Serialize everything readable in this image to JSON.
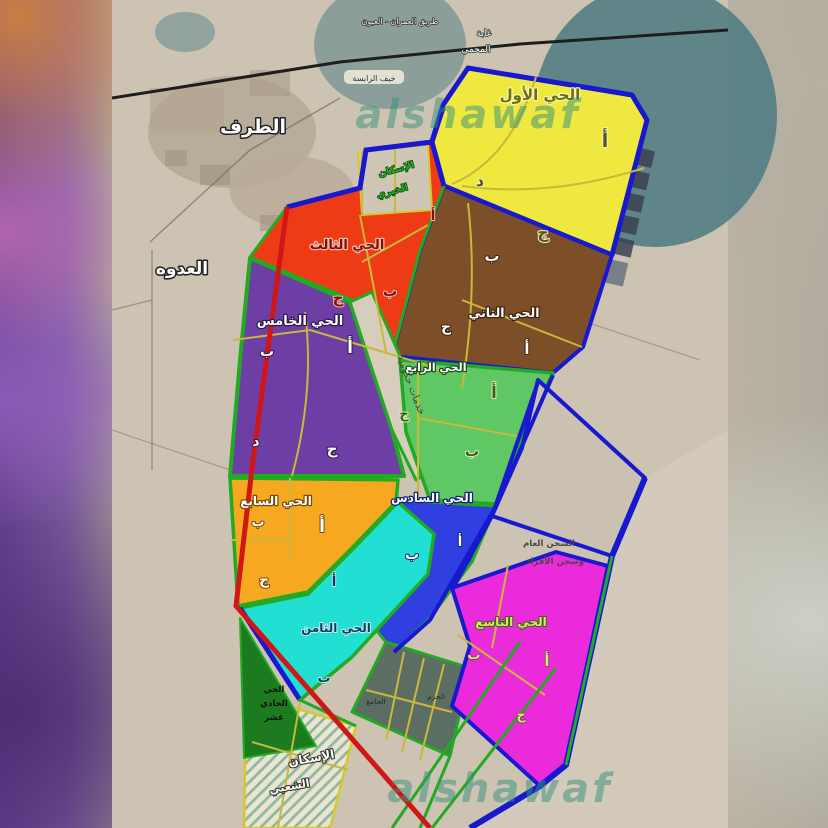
{
  "watermark": {
    "text": "alshawaf",
    "color": "#36907c"
  },
  "base_map": {
    "town_left": "الطرف",
    "town_left2": "العدوه",
    "road_top": "طريق العمران - العيون",
    "village_pill": "خيف الرابسة",
    "forest_l1": "غابة",
    "forest_l2": "المحمي"
  },
  "districts": [
    {
      "name": "الحي الأول",
      "color": "#efe93f",
      "sections": [
        "أ",
        "د",
        "ج"
      ]
    },
    {
      "name": "الحي الثاني",
      "color": "#7c4f28",
      "sections": [
        "ب",
        "ج",
        "أ"
      ]
    },
    {
      "name": "الحي الثالث",
      "color": "#ee3b16",
      "sections": [
        "أ",
        "ج",
        "ب"
      ]
    },
    {
      "name": "الحي الرابع",
      "color": "#5fc763",
      "sections": [
        "أ",
        "ب",
        "ج"
      ]
    },
    {
      "name": "الحي الخامس",
      "color": "#6d3fa5",
      "sections": [
        "ب",
        "أ",
        "د",
        "ج"
      ]
    },
    {
      "name": "الحي السادس",
      "color": "#2f3fe0",
      "sections": [
        "أ",
        "ب"
      ]
    },
    {
      "name": "الحي السابع",
      "color": "#f6a821",
      "sections": [
        "ب",
        "أ",
        "ج"
      ]
    },
    {
      "name": "الحي الثامن",
      "color": "#22dfd3",
      "sections": [
        "أ",
        "ب"
      ]
    },
    {
      "name": "الحي التاسع",
      "color": "#eb2bdb",
      "sections": [
        "ب",
        "أ",
        "ج"
      ]
    },
    {
      "name_l1": "الحي",
      "name_l2": "الحادي",
      "name_l3": "عشر",
      "color": "#1c7a1f"
    }
  ],
  "areas": {
    "gov_services": "خدمات حكومية",
    "charity_l1": "الإسكان",
    "charity_l2": "الخيري",
    "housing_l1": "الإسكان",
    "housing_l2": "الشعبي",
    "prison_l1": "السجن العام",
    "prison_l2": "وسجن الأفراد",
    "mosque": "الجامع",
    "haram": "الحرم"
  }
}
